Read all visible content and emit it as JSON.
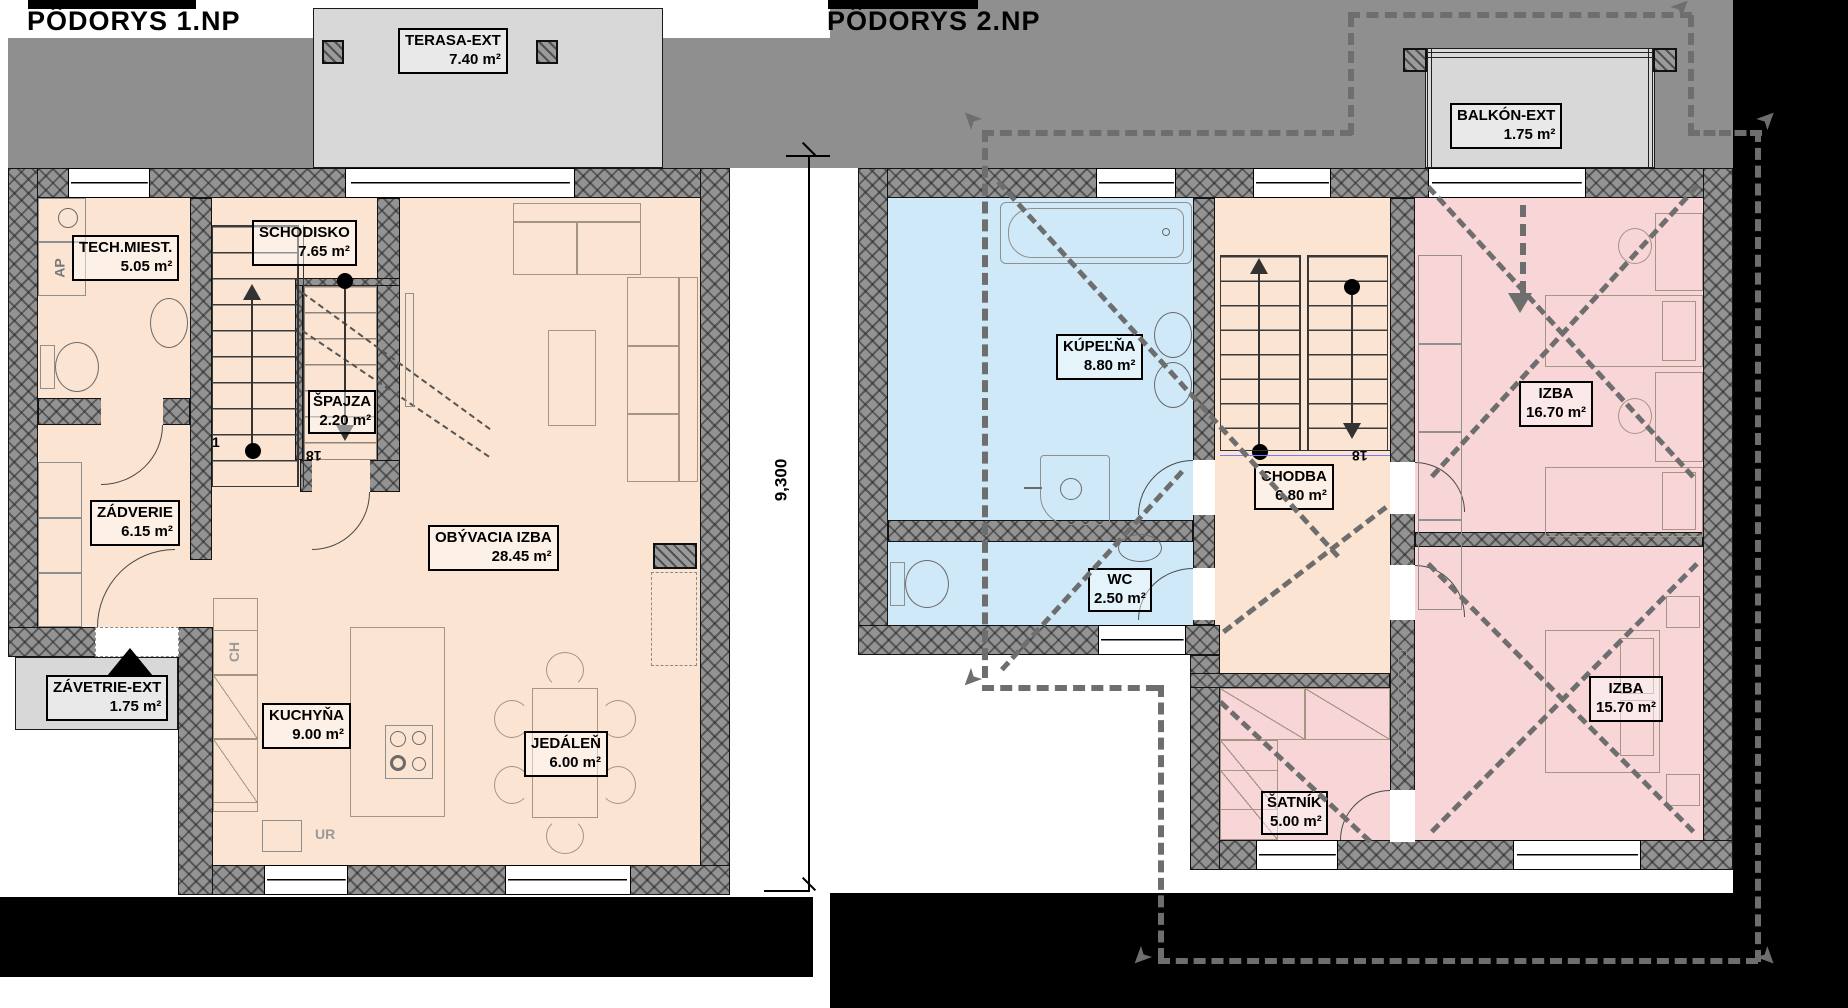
{
  "titles": {
    "plan1": "PÔDORYS 1.NP",
    "plan2": "PÔDORYS 2.NP"
  },
  "dimension": {
    "value": "9,300"
  },
  "plan1": {
    "rooms": {
      "tech": {
        "name": "TECH.MIEST.",
        "area": "5.05 m²"
      },
      "schodisko": {
        "name": "SCHODISKO",
        "area": "7.65 m²"
      },
      "spajza": {
        "name": "ŠPAJZA",
        "area": "2.20 m²"
      },
      "zadverie": {
        "name": "ZÁDVERIE",
        "area": "6.15 m²"
      },
      "obyvacia": {
        "name": "OBÝVACIA IZBA",
        "area": "28.45 m²"
      },
      "kuchyna": {
        "name": "KUCHYŇA",
        "area": "9.00 m²"
      },
      "jedalen": {
        "name": "JEDÁLEŇ",
        "area": "6.00 m²"
      },
      "terasa": {
        "name": "TERASA-EXT",
        "area": "7.40 m²"
      },
      "zavetrie": {
        "name": "ZÁVETRIE-EXT",
        "area": "1.75 m²"
      }
    },
    "ann": {
      "ap": "AP",
      "ch": "CH",
      "ur": "UR",
      "stair_first": "1",
      "stair_last": "18"
    }
  },
  "plan2": {
    "rooms": {
      "kupelna": {
        "name": "KÚPEĽŇA",
        "area": "8.80 m²"
      },
      "wc": {
        "name": "WC",
        "area": "2.50 m²"
      },
      "chodba": {
        "name": "CHODBA",
        "area": "6.80 m²"
      },
      "izba1": {
        "name": "IZBA",
        "area": "16.70 m²"
      },
      "izba2": {
        "name": "IZBA",
        "area": "15.70 m²"
      },
      "satnik": {
        "name": "ŠATNÍK",
        "area": "5.00 m²"
      },
      "balkon": {
        "name": "BALKÓN-EXT",
        "area": "1.75 m²"
      }
    },
    "ann": {
      "stair_last": "18"
    }
  },
  "colors": {
    "room_peach": "#fbe4d1",
    "room_blue": "#cfe9f8",
    "room_pink": "#f8d6d8",
    "roof_gray": "#8f8f8f",
    "exterior_gray": "#d8d8d8",
    "wall_gray": "#939393",
    "mask_black": "#000000"
  }
}
